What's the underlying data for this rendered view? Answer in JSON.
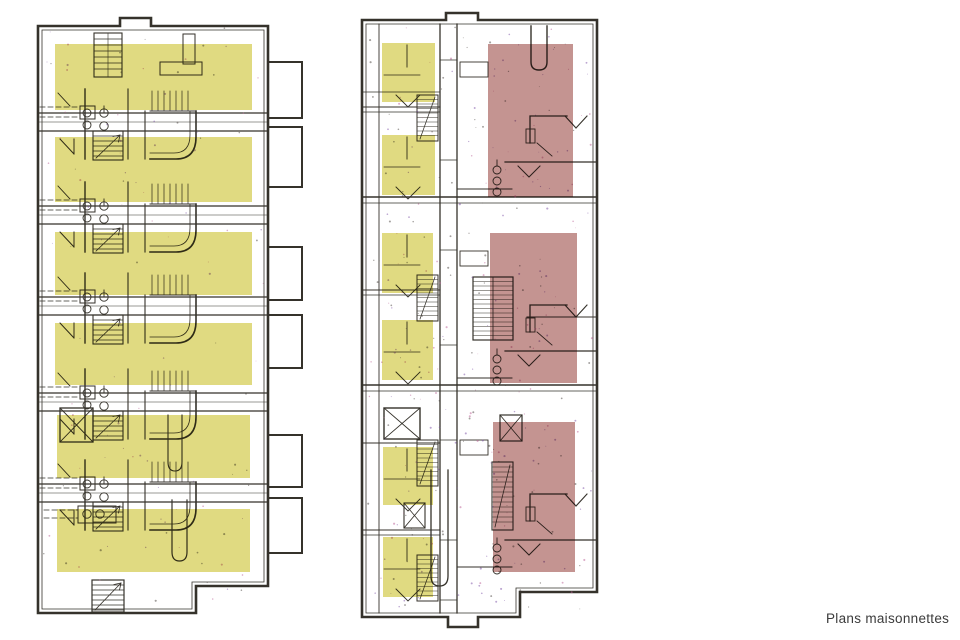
{
  "caption": {
    "label": "Plans maisonnettes"
  },
  "palette": {
    "background": "#ffffff",
    "line": "#35322b",
    "highlight_yellow": "#ded777",
    "highlight_red": "#c08c89",
    "noise_colors": [
      "#bb5f95",
      "#7b4fa5",
      "#4a4440"
    ]
  },
  "plans": {
    "left": {
      "name": "plan-gauche-maisonnettes",
      "highlights": [
        {
          "x": 55,
          "y": 44,
          "w": 197,
          "h": 66
        },
        {
          "x": 55,
          "y": 137,
          "w": 197,
          "h": 65
        },
        {
          "x": 55,
          "y": 232,
          "w": 197,
          "h": 63
        },
        {
          "x": 55,
          "y": 323,
          "w": 197,
          "h": 62
        },
        {
          "x": 57,
          "y": 415,
          "w": 193,
          "h": 63
        },
        {
          "x": 57,
          "y": 509,
          "w": 193,
          "h": 63
        }
      ]
    },
    "right": {
      "name": "plan-droite-maisonnettes",
      "yellow_highlights": [
        {
          "x": 382,
          "y": 43,
          "w": 53,
          "h": 59
        },
        {
          "x": 382,
          "y": 135,
          "w": 53,
          "h": 60
        },
        {
          "x": 382,
          "y": 233,
          "w": 51,
          "h": 60
        },
        {
          "x": 382,
          "y": 320,
          "w": 51,
          "h": 60
        },
        {
          "x": 383,
          "y": 447,
          "w": 50,
          "h": 58
        },
        {
          "x": 383,
          "y": 537,
          "w": 50,
          "h": 60
        }
      ],
      "red_highlights": [
        {
          "x": 488,
          "y": 44,
          "w": 85,
          "h": 153
        },
        {
          "x": 490,
          "y": 233,
          "w": 87,
          "h": 150
        },
        {
          "x": 493,
          "y": 422,
          "w": 82,
          "h": 150
        }
      ]
    }
  }
}
